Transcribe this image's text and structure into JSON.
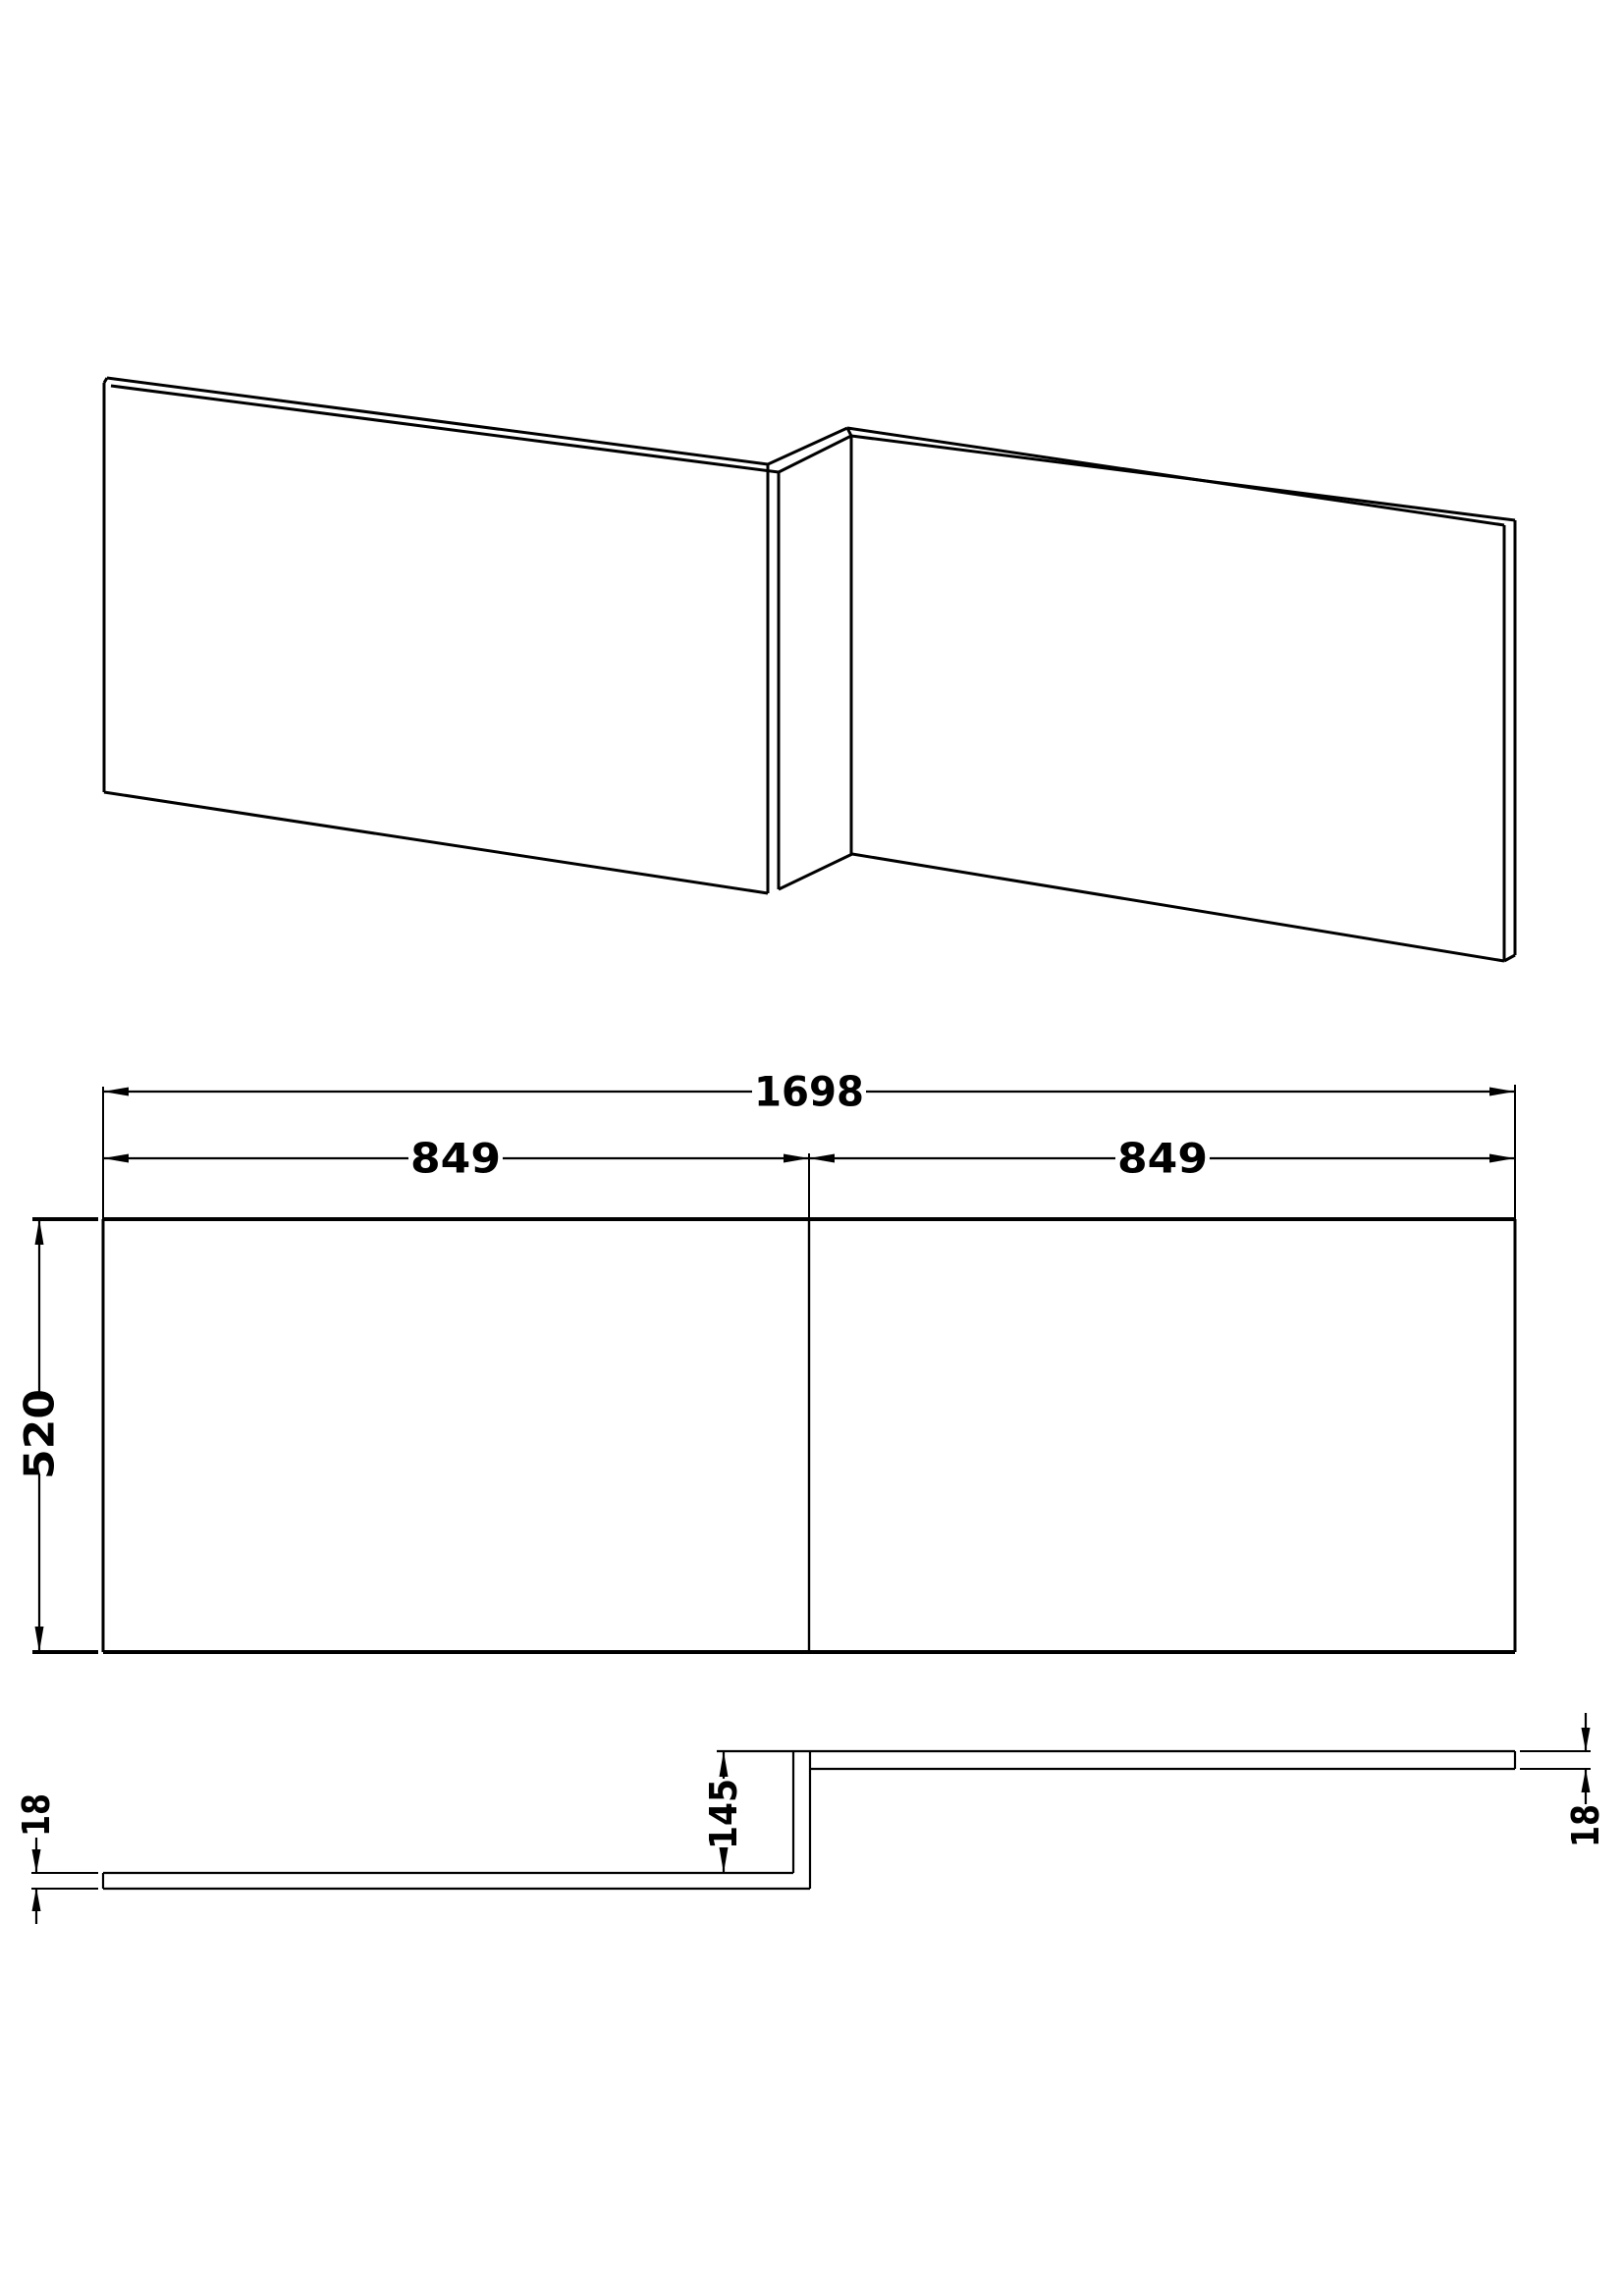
{
  "colors": {
    "line": "#000000",
    "background": "#ffffff"
  },
  "views": {
    "front_elevation": {
      "width_total": "1698",
      "width_left": "849",
      "width_right": "849",
      "height": "520"
    },
    "plan_section": {
      "return_depth": "145",
      "thickness_left": "18",
      "thickness_right": "18"
    }
  }
}
